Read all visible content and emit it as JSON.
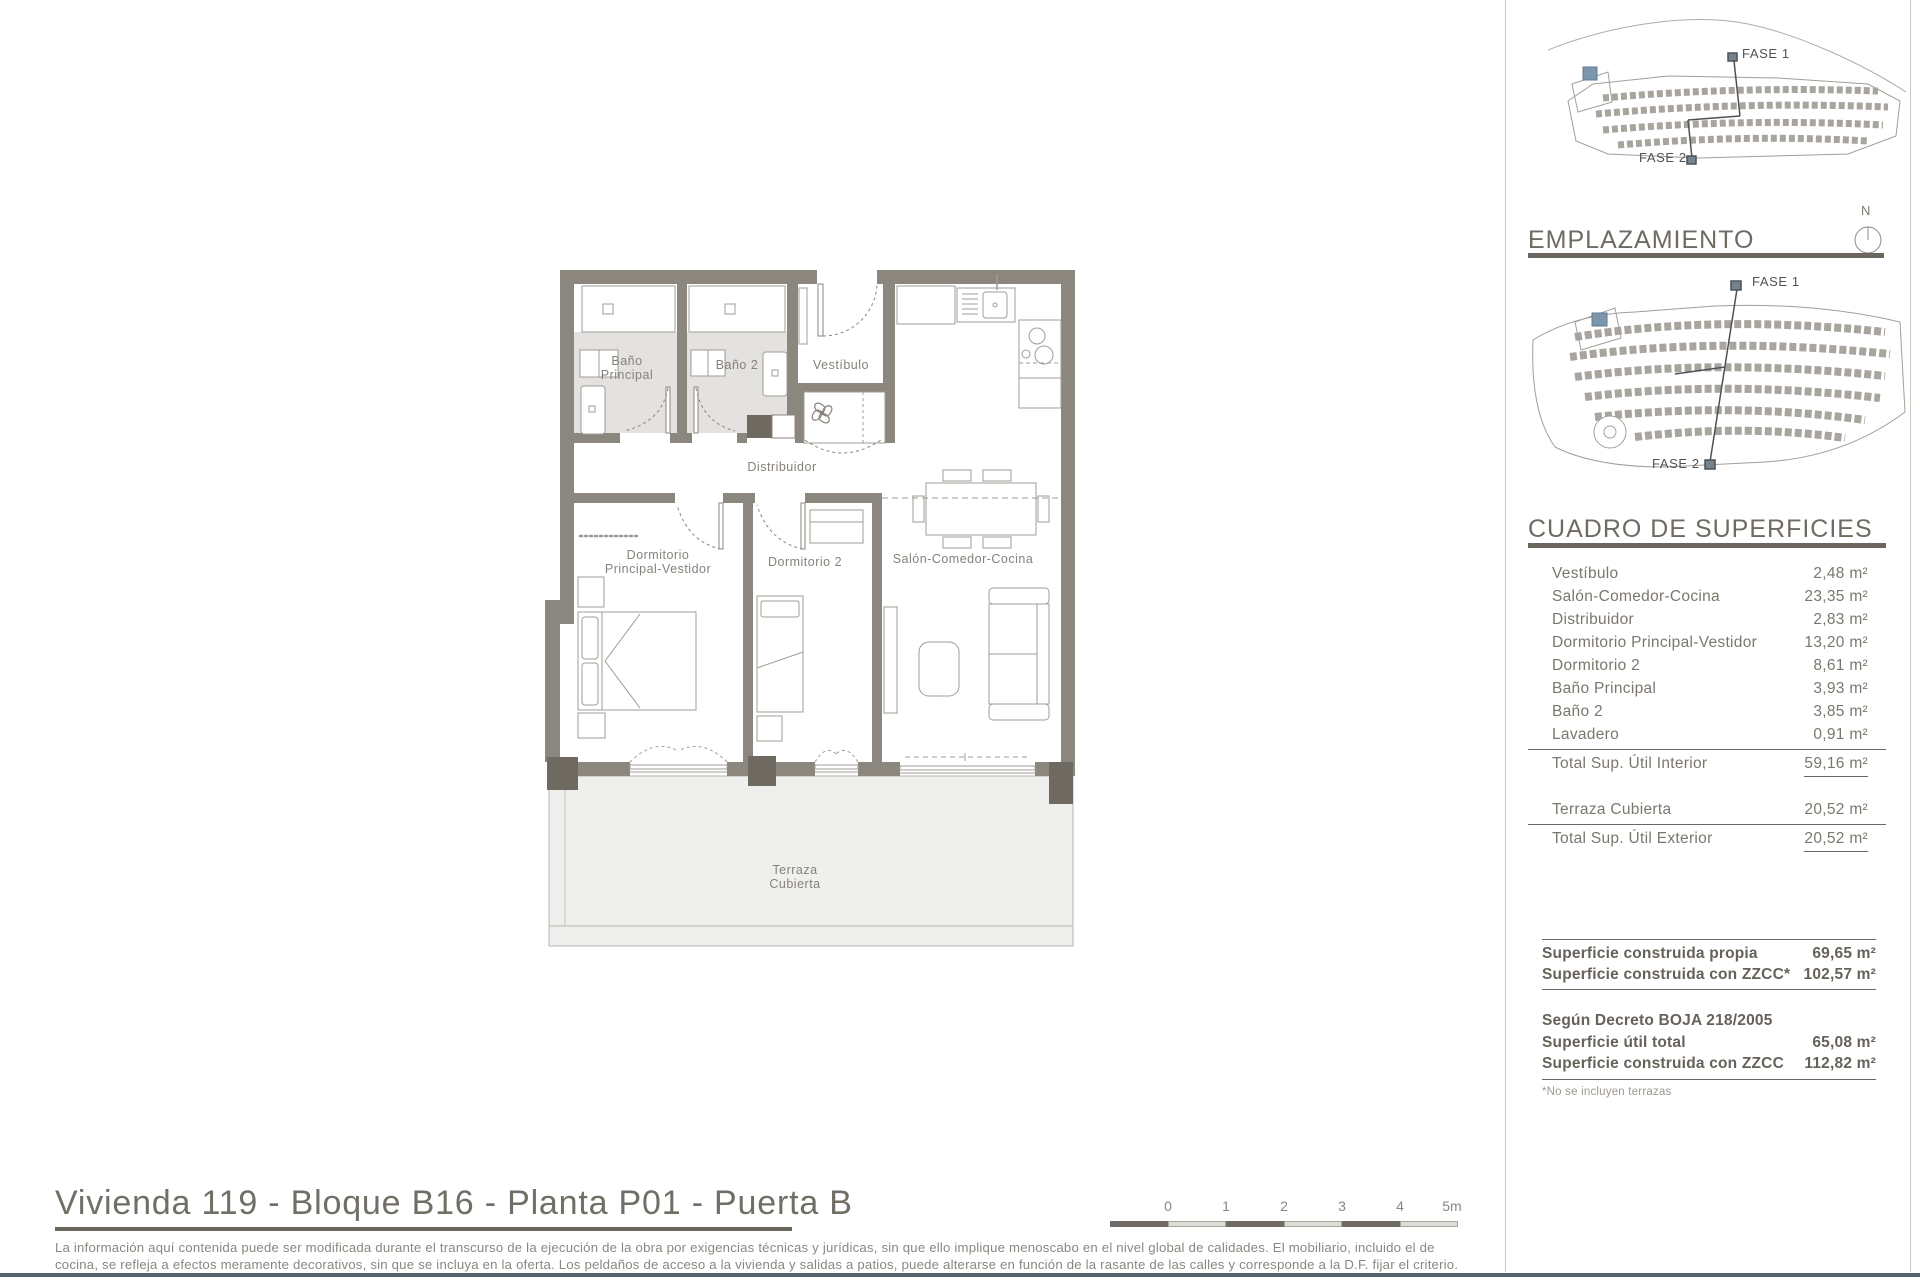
{
  "page": {
    "title": "Vivienda 119 - Bloque B16 - Planta P01 - Puerta B",
    "disclaimer_line1": "La información aquí contenida puede ser modificada durante el transcurso de la ejecución de la obra por exigencias técnicas y jurídicas, sin que ello implique menoscabo en el nivel global de calidades. El mobiliario, incluido el de",
    "disclaimer_line2": "cocina, se refleja a efectos meramente decorativos, sin que se incluya en la oferta. Los peldaños de acceso a la vivienda y salidas a patios, puede alterarse en función de la rasante de las calles y corresponde a la D.F. fijar el criterio."
  },
  "scale_bar": {
    "labels": [
      "0",
      "1",
      "2",
      "3",
      "4",
      "5m"
    ]
  },
  "site": {
    "emplazamiento_title": "EMPLAZAMIENTO",
    "north_label": "N",
    "fase1_label": "FASE 1",
    "fase2_label": "FASE 2"
  },
  "surfaces": {
    "title": "CUADRO DE SUPERFICIES",
    "rows": [
      {
        "label": "Vestíbulo",
        "value": "2,48 m²"
      },
      {
        "label": "Salón-Comedor-Cocina",
        "value": "23,35 m²"
      },
      {
        "label": "Distribuidor",
        "value": "2,83 m²"
      },
      {
        "label": "Dormitorio Principal-Vestidor",
        "value": "13,20 m²"
      },
      {
        "label": "Dormitorio 2",
        "value": "8,61 m²"
      },
      {
        "label": "Baño Principal",
        "value": "3,93 m²"
      },
      {
        "label": "Baño 2",
        "value": "3,85 m²"
      },
      {
        "label": "Lavadero",
        "value": "0,91 m²"
      }
    ],
    "total_interior": {
      "label": "Total Sup. Útil Interior",
      "value": "59,16 m²"
    },
    "exterior_rows": [
      {
        "label": "Terraza Cubierta",
        "value": "20,52 m²"
      }
    ],
    "total_exterior": {
      "label": "Total Sup. Útil Exterior",
      "value": "20,52 m²"
    }
  },
  "built": {
    "rows": [
      {
        "label": "Superficie construida propia",
        "value": "69,65 m²"
      },
      {
        "label": "Superficie construida con ZZCC*",
        "value": "102,57 m²"
      }
    ],
    "decree_heading": "Según Decreto BOJA 218/2005",
    "decree_rows": [
      {
        "label": "Superficie útil total",
        "value": "65,08 m²"
      },
      {
        "label": "Superficie construida con ZZCC",
        "value": "112,82 m²"
      }
    ],
    "footnote": "*No se incluyen terrazas"
  },
  "floor_plan": {
    "labels": {
      "bano_principal_1": "Baño",
      "bano_principal_2": "Principal",
      "bano_2": "Baño 2",
      "vestibulo": "Vestíbulo",
      "distribuidor": "Distribuidor",
      "dormitorio_principal_1": "Dormitorio",
      "dormitorio_principal_2": "Principal-Vestidor",
      "dormitorio_2": "Dormitorio 2",
      "salon": "Salón-Comedor-Cocina",
      "terraza_1": "Terraza",
      "terraza_2": "Cubierta"
    }
  }
}
